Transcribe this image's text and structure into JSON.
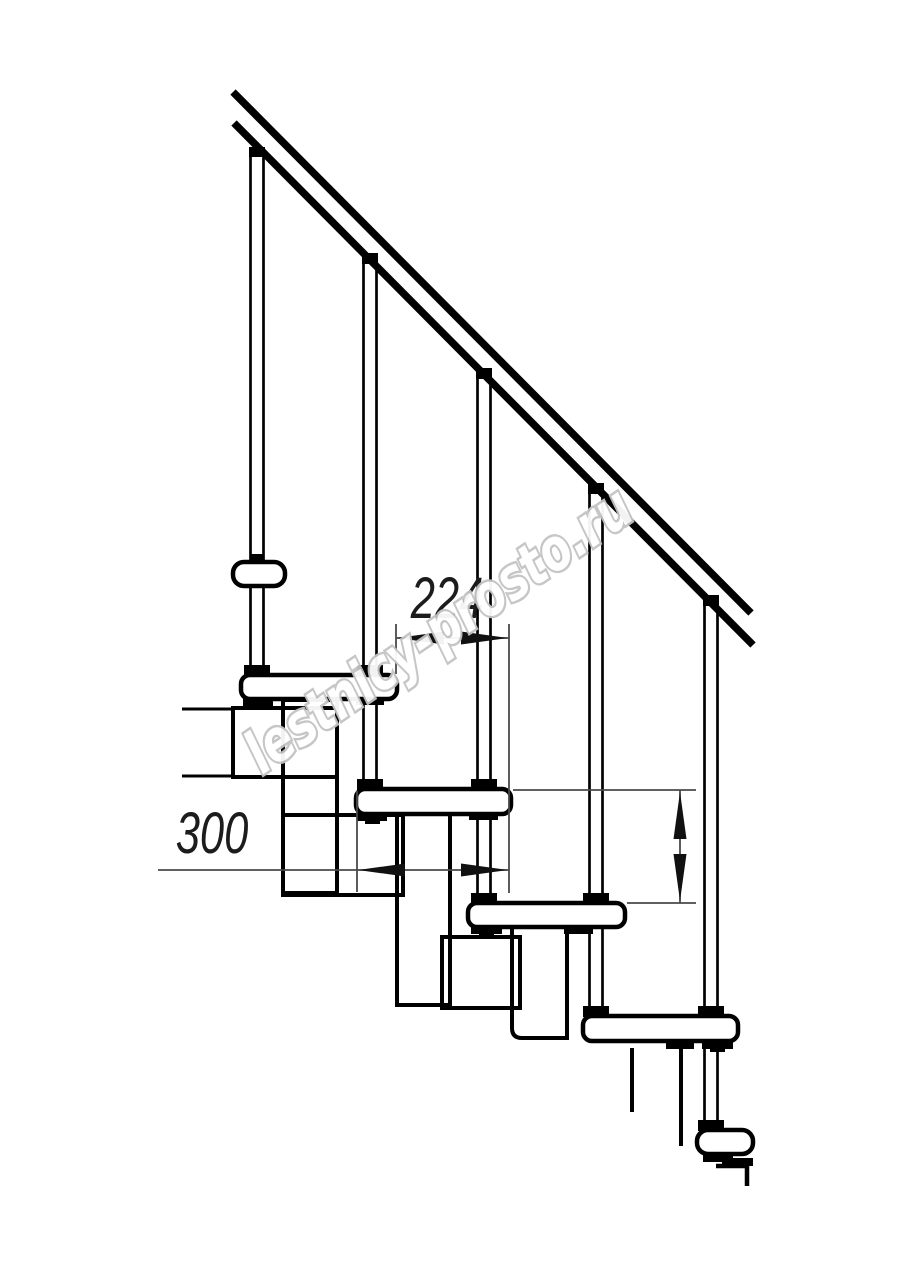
{
  "page": {
    "background": "#ffffff"
  },
  "drawing": {
    "kind": "modular staircase side-view technical drawing",
    "dimensions": {
      "step_run": {
        "value": "224"
      },
      "tread_depth": {
        "value": "300"
      },
      "step_rise": {
        "value": "225"
      }
    },
    "watermark": {
      "text": "lestnicy-prosto.ru",
      "outline_color": "#c3c3c3"
    },
    "colors": {
      "main_line": "#000000",
      "dimension_line": "#4a4a4a",
      "dimension_text": "#1c1c1c"
    },
    "counts": {
      "balusters": 5,
      "treads": 4
    }
  }
}
